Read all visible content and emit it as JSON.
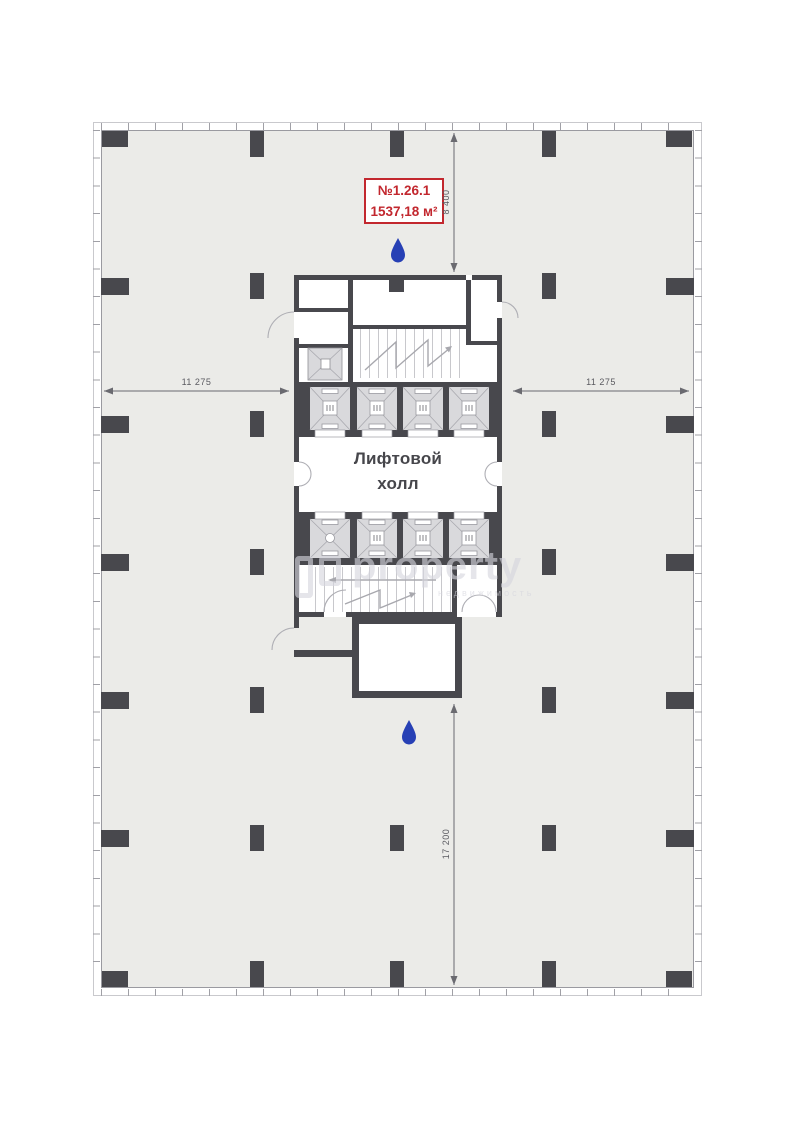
{
  "unit_label": {
    "number": "№1.26.1",
    "area": "1537,18 м²"
  },
  "elevator_hall": {
    "line1": "Лифтовой",
    "line2": "холл"
  },
  "dimensions": {
    "left_span": "11 275",
    "right_span": "11 275",
    "top_span": "8 400",
    "bottom_span": "17 200"
  },
  "watermark": {
    "main": "property",
    "sub": "недвижимость"
  },
  "colors": {
    "accent_red": "#c2272e",
    "drop_blue": "#2740b5",
    "wall_dark": "#48484d",
    "floor_gray": "#ebebe8",
    "elevator_gray": "#d9d9dc"
  }
}
